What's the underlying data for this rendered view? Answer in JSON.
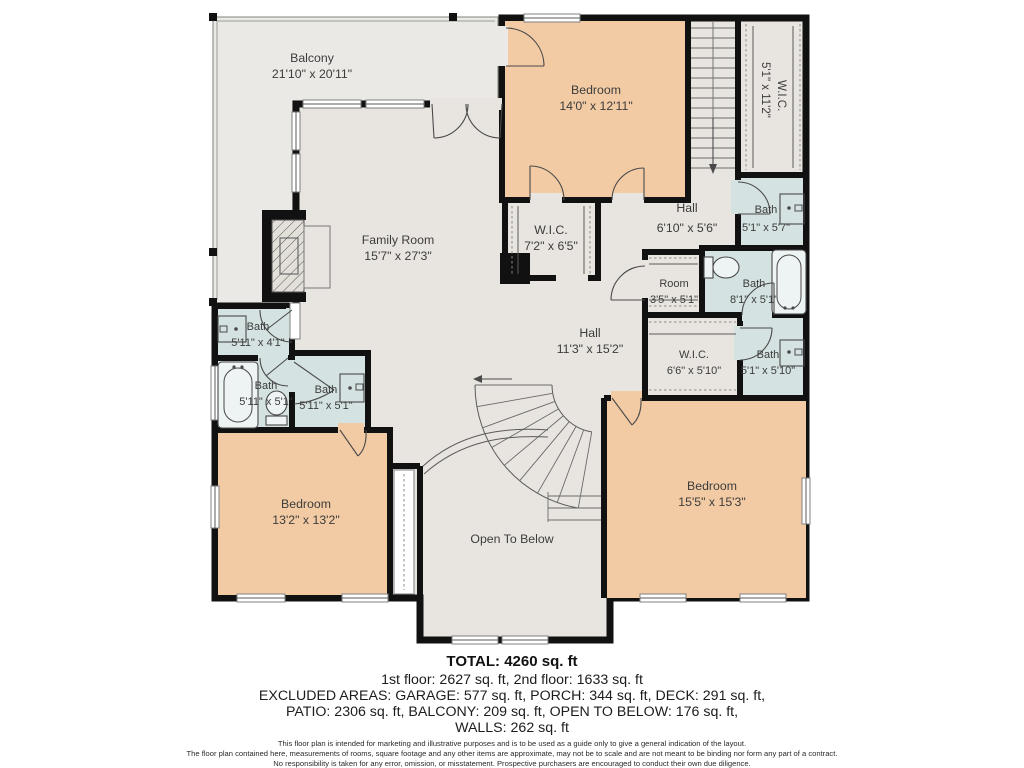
{
  "plan": {
    "rooms": {
      "balcony": {
        "name": "Balcony",
        "dims": "21'10\" x 20'11\""
      },
      "bedroom_top": {
        "name": "Bedroom",
        "dims": "14'0\" x 12'11\""
      },
      "wic_top_right": {
        "name": "W.I.C.",
        "dims": "5'1\" x 11'2\""
      },
      "family_room": {
        "name": "Family Room",
        "dims": "15'7\" x 27'3\""
      },
      "wic_center": {
        "name": "W.I.C.",
        "dims": "7'2\" x 6'5\""
      },
      "hall_upper": {
        "name": "Hall",
        "dims": "6'10\" x 5'6\""
      },
      "bath_top_right": {
        "name": "Bath",
        "dims": "5'1\" x 5'7\""
      },
      "room_closet": {
        "name": "Room",
        "dims": "3'5\" x 5'1\""
      },
      "bath_mid_right": {
        "name": "Bath",
        "dims": "8'1\" x 5'1\""
      },
      "hall_main": {
        "name": "Hall",
        "dims": "11'3\" x 15'2\""
      },
      "wic_right": {
        "name": "W.I.C.",
        "dims": "6'6\" x 5'10\""
      },
      "bath_low_right": {
        "name": "Bath",
        "dims": "5'1\" x 5'10\""
      },
      "bath_left_1": {
        "name": "Bath",
        "dims": "5'11\" x 4'1\""
      },
      "bath_left_2": {
        "name": "Bath",
        "dims": "5'11\" x 5'1\""
      },
      "bath_left_3": {
        "name": "Bath",
        "dims": "5'11\" x 5'1\""
      },
      "bedroom_left": {
        "name": "Bedroom",
        "dims": "13'2\" x 13'2\""
      },
      "bedroom_right": {
        "name": "Bedroom",
        "dims": "15'5\" x 15'3\""
      },
      "open_below": {
        "name": "Open To Below"
      }
    },
    "summary": {
      "total": "TOTAL: 4260 sq. ft",
      "line1": "1st floor: 2627 sq. ft, 2nd floor: 1633 sq. ft",
      "line2": "EXCLUDED AREAS: GARAGE: 577 sq. ft, PORCH: 344 sq. ft, DECK: 291 sq. ft,",
      "line3": "PATIO: 2306 sq. ft, BALCONY: 209 sq. ft, OPEN TO BELOW: 176 sq. ft,",
      "line4": "WALLS: 262 sq. ft"
    },
    "disclaimer": {
      "line1": "This floor plan is intended for marketing and illustrative purposes and is to be used as a guide only to give a general indication of the layout.",
      "line2": "The floor plan contained here, measurements of rooms, square footage and any other items are approximate, may not be to scale and are not meant to be binding nor form any part of a contract.",
      "line3": "No responsibility is taken for any error, omission, or misstatement. Prospective purchasers are encouraged to conduct their own due diligence."
    },
    "colors": {
      "bedroom": "#f2cba4",
      "bath": "#d5e2e2",
      "floor": "#e8e5e0",
      "balcony": "#ebe9e6",
      "wall": "#111111"
    }
  }
}
